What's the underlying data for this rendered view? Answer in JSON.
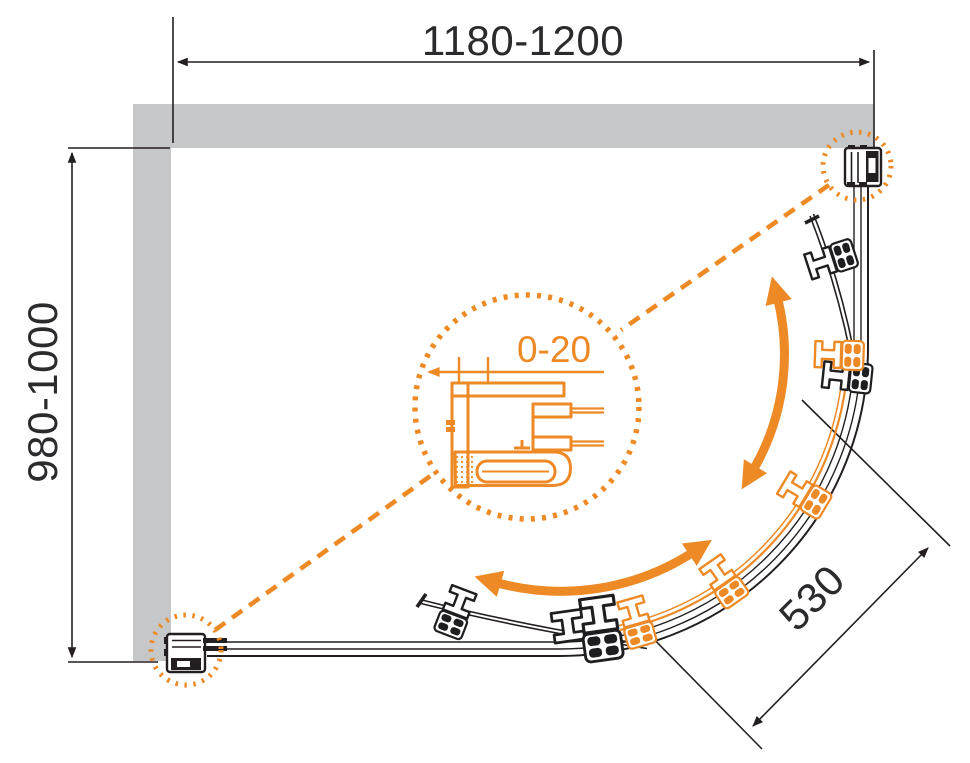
{
  "dimensions": {
    "width": "1180-1200",
    "depth": "980-1000",
    "door_opening": "530",
    "adjustment": "0-20"
  },
  "colors": {
    "accent_orange": "#ED8A26",
    "wall_gray": "#C6C7C9",
    "line_black": "#231F20",
    "background": "#FFFFFF"
  }
}
